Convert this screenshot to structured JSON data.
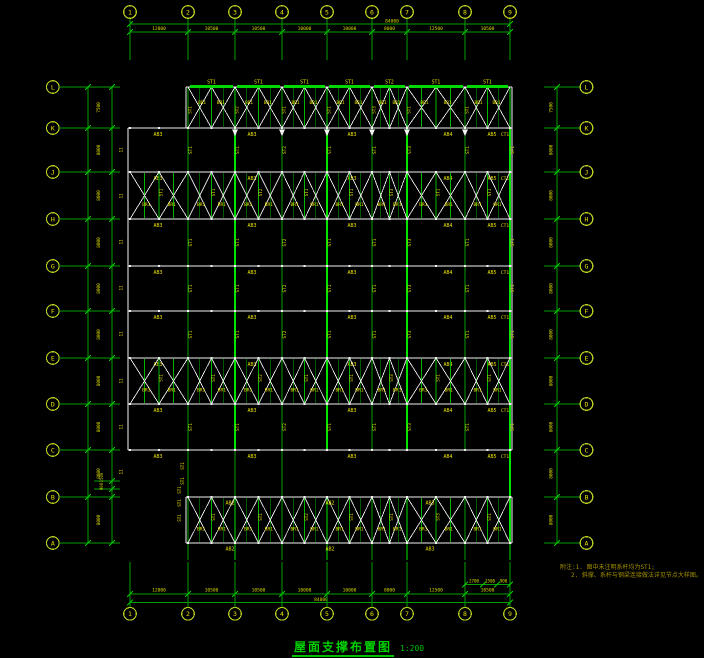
{
  "palette": {
    "grid_green": "#00a000",
    "bright_green": "#00e400",
    "bar_green": "#00d800",
    "tie_green": "#00b400",
    "tick_green": "#00cc00",
    "member_white": "#f2f2f2",
    "label_yellow": "#e8e000",
    "dim_yellow": "#d8d800",
    "bubble_ring": "#b8cc20",
    "bubble_text": "#e8e000"
  },
  "axes": {
    "top": {
      "bubbles": [
        "1",
        "2",
        "3",
        "4",
        "5",
        "6",
        "7",
        "8",
        "9"
      ],
      "dims": [
        "12000",
        "10500",
        "10500",
        "10000",
        "10000",
        "8000",
        "12500",
        "10500"
      ],
      "overall": "84000"
    },
    "bottom": {
      "bubbles": [
        "1",
        "2",
        "3",
        "4",
        "5",
        "6",
        "7",
        "8",
        "9"
      ],
      "dims": [
        "12000",
        "10500",
        "10500",
        "10000",
        "10000",
        "8000",
        "12500",
        "10500"
      ],
      "overall": "84000",
      "sub_dims": [
        "2700",
        "1500",
        "900"
      ]
    },
    "left": {
      "bubbles": [
        "L",
        "K",
        "J",
        "H",
        "G",
        "F",
        "E",
        "D",
        "C",
        "B",
        "A"
      ],
      "dims": [
        "7500",
        "8000",
        "8000",
        "8000",
        "8000",
        "8000",
        "8000",
        "8000",
        "8000",
        "8000"
      ],
      "sub_dims": [
        "1500",
        "900"
      ]
    },
    "right": {
      "bubbles": [
        "L",
        "K",
        "J",
        "H",
        "G",
        "F",
        "E",
        "D",
        "C",
        "B",
        "A"
      ],
      "dims": [
        "7500",
        "8000",
        "8000",
        "8000",
        "8000",
        "8000",
        "8000",
        "8000",
        "8000",
        "8000"
      ]
    }
  },
  "members": {
    "purlin_labels": [
      "ST1",
      "ST1",
      "ST1",
      "ST1",
      "ST2",
      "ST1",
      "ST1"
    ],
    "beam_labels": [
      "AB3",
      "AB3",
      "AB3",
      "AB4",
      "AB5"
    ],
    "edge_beam_label": "CT1",
    "strip_labels": [
      "AB2",
      "AB2",
      "AB3"
    ],
    "tie_labels": [
      "ST1",
      "ST1",
      "ST2",
      "ST1",
      "ST1",
      "ST3",
      "ST1",
      "ST1"
    ],
    "brace_label": "BR1",
    "corner_tie_label": "ST1",
    "joint_mark": "11"
  },
  "title": {
    "text": "屋面支撑布置图",
    "scale": "1:200"
  },
  "notes": {
    "line1": "附注:1. 图中未注明系杆均为ST1;",
    "line2": "2. 斜撑、系杆与钢梁连接做法详见节点大样图。"
  }
}
